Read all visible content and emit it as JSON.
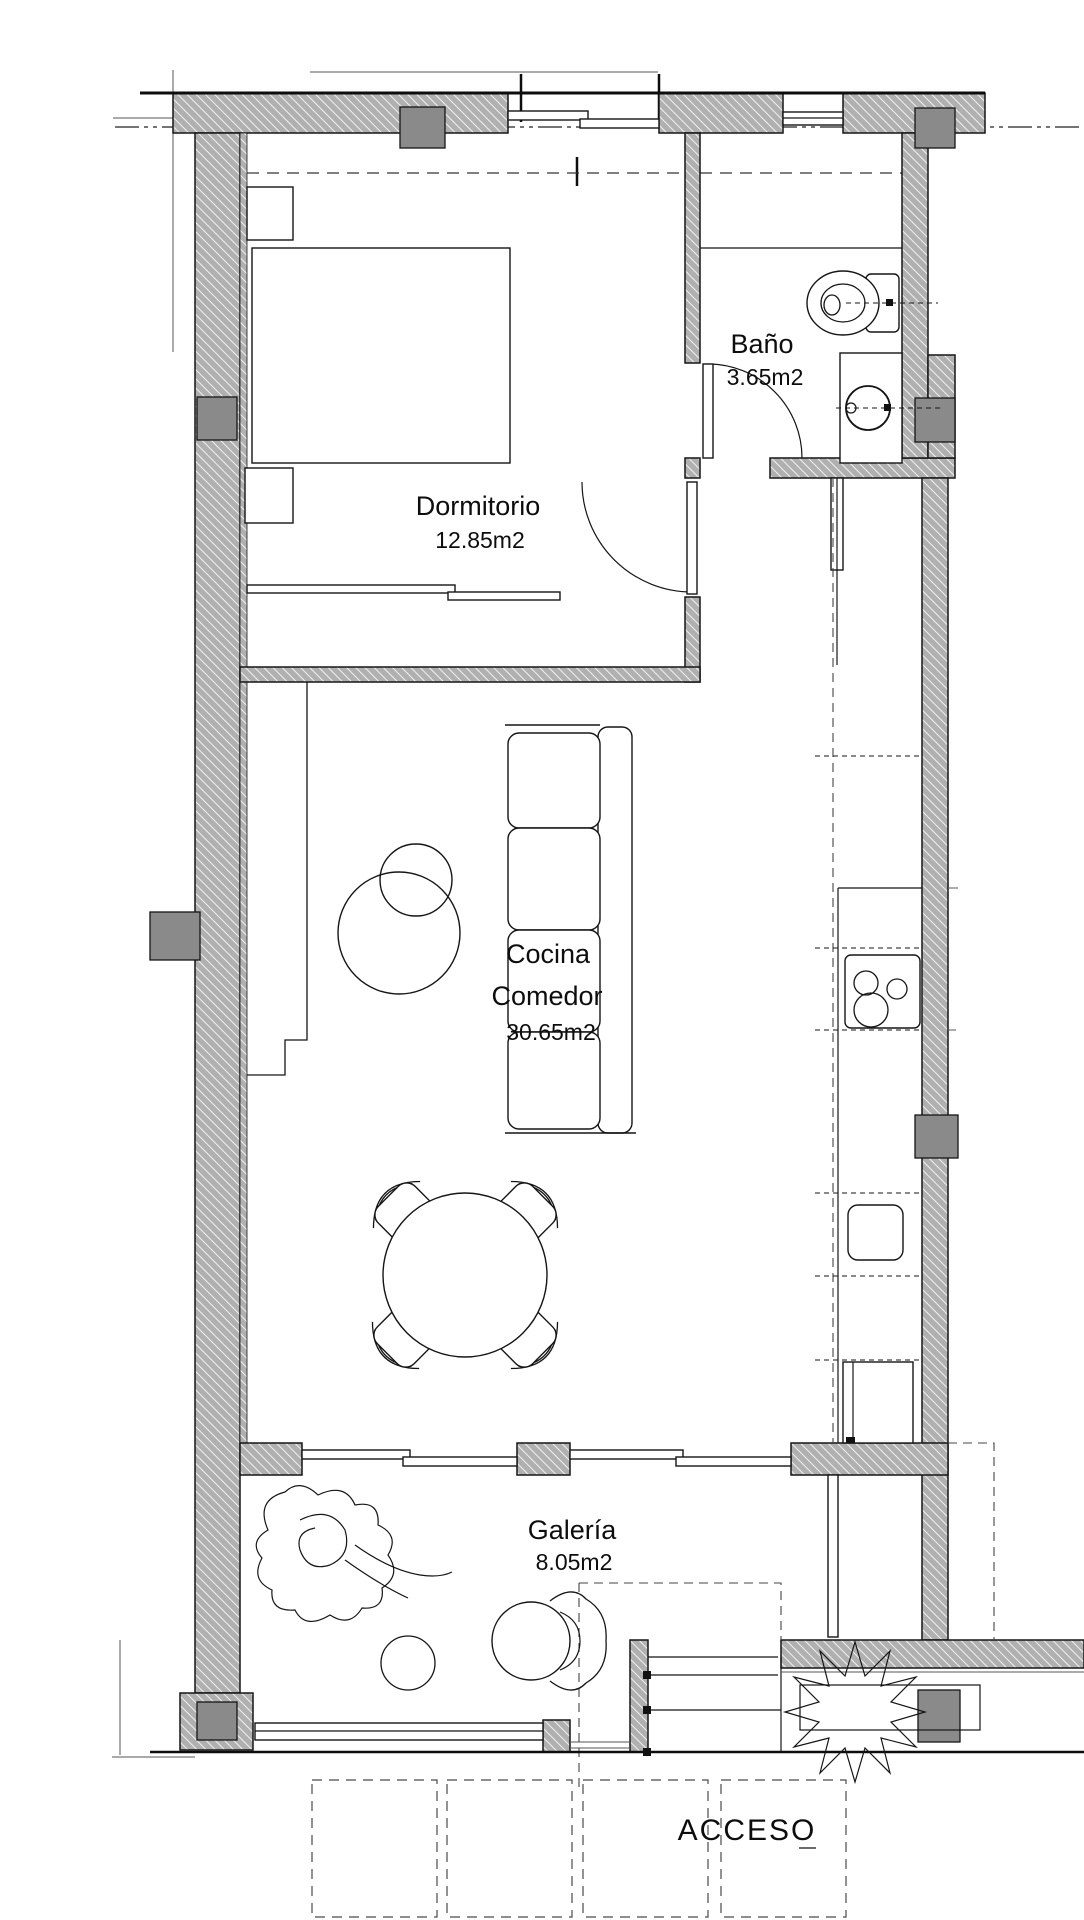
{
  "plan": {
    "rooms": {
      "dormitorio": {
        "name": "Dormitorio",
        "area": "12.85m2"
      },
      "bano": {
        "name": "Baño",
        "area": "3.65m2"
      },
      "cocina_comedor": {
        "name_line1": "Cocina",
        "name_line2": "Comedor",
        "area": "30.65m2"
      },
      "galeria": {
        "name": "Galería",
        "area": "8.05m2"
      },
      "acceso": {
        "name": "ACCESO"
      }
    },
    "colors": {
      "wall_fill": "#b0b0b0",
      "wall_hatch_line": "#f1f1f1",
      "column_fill": "#8a8a8a",
      "line": "#151515"
    }
  }
}
